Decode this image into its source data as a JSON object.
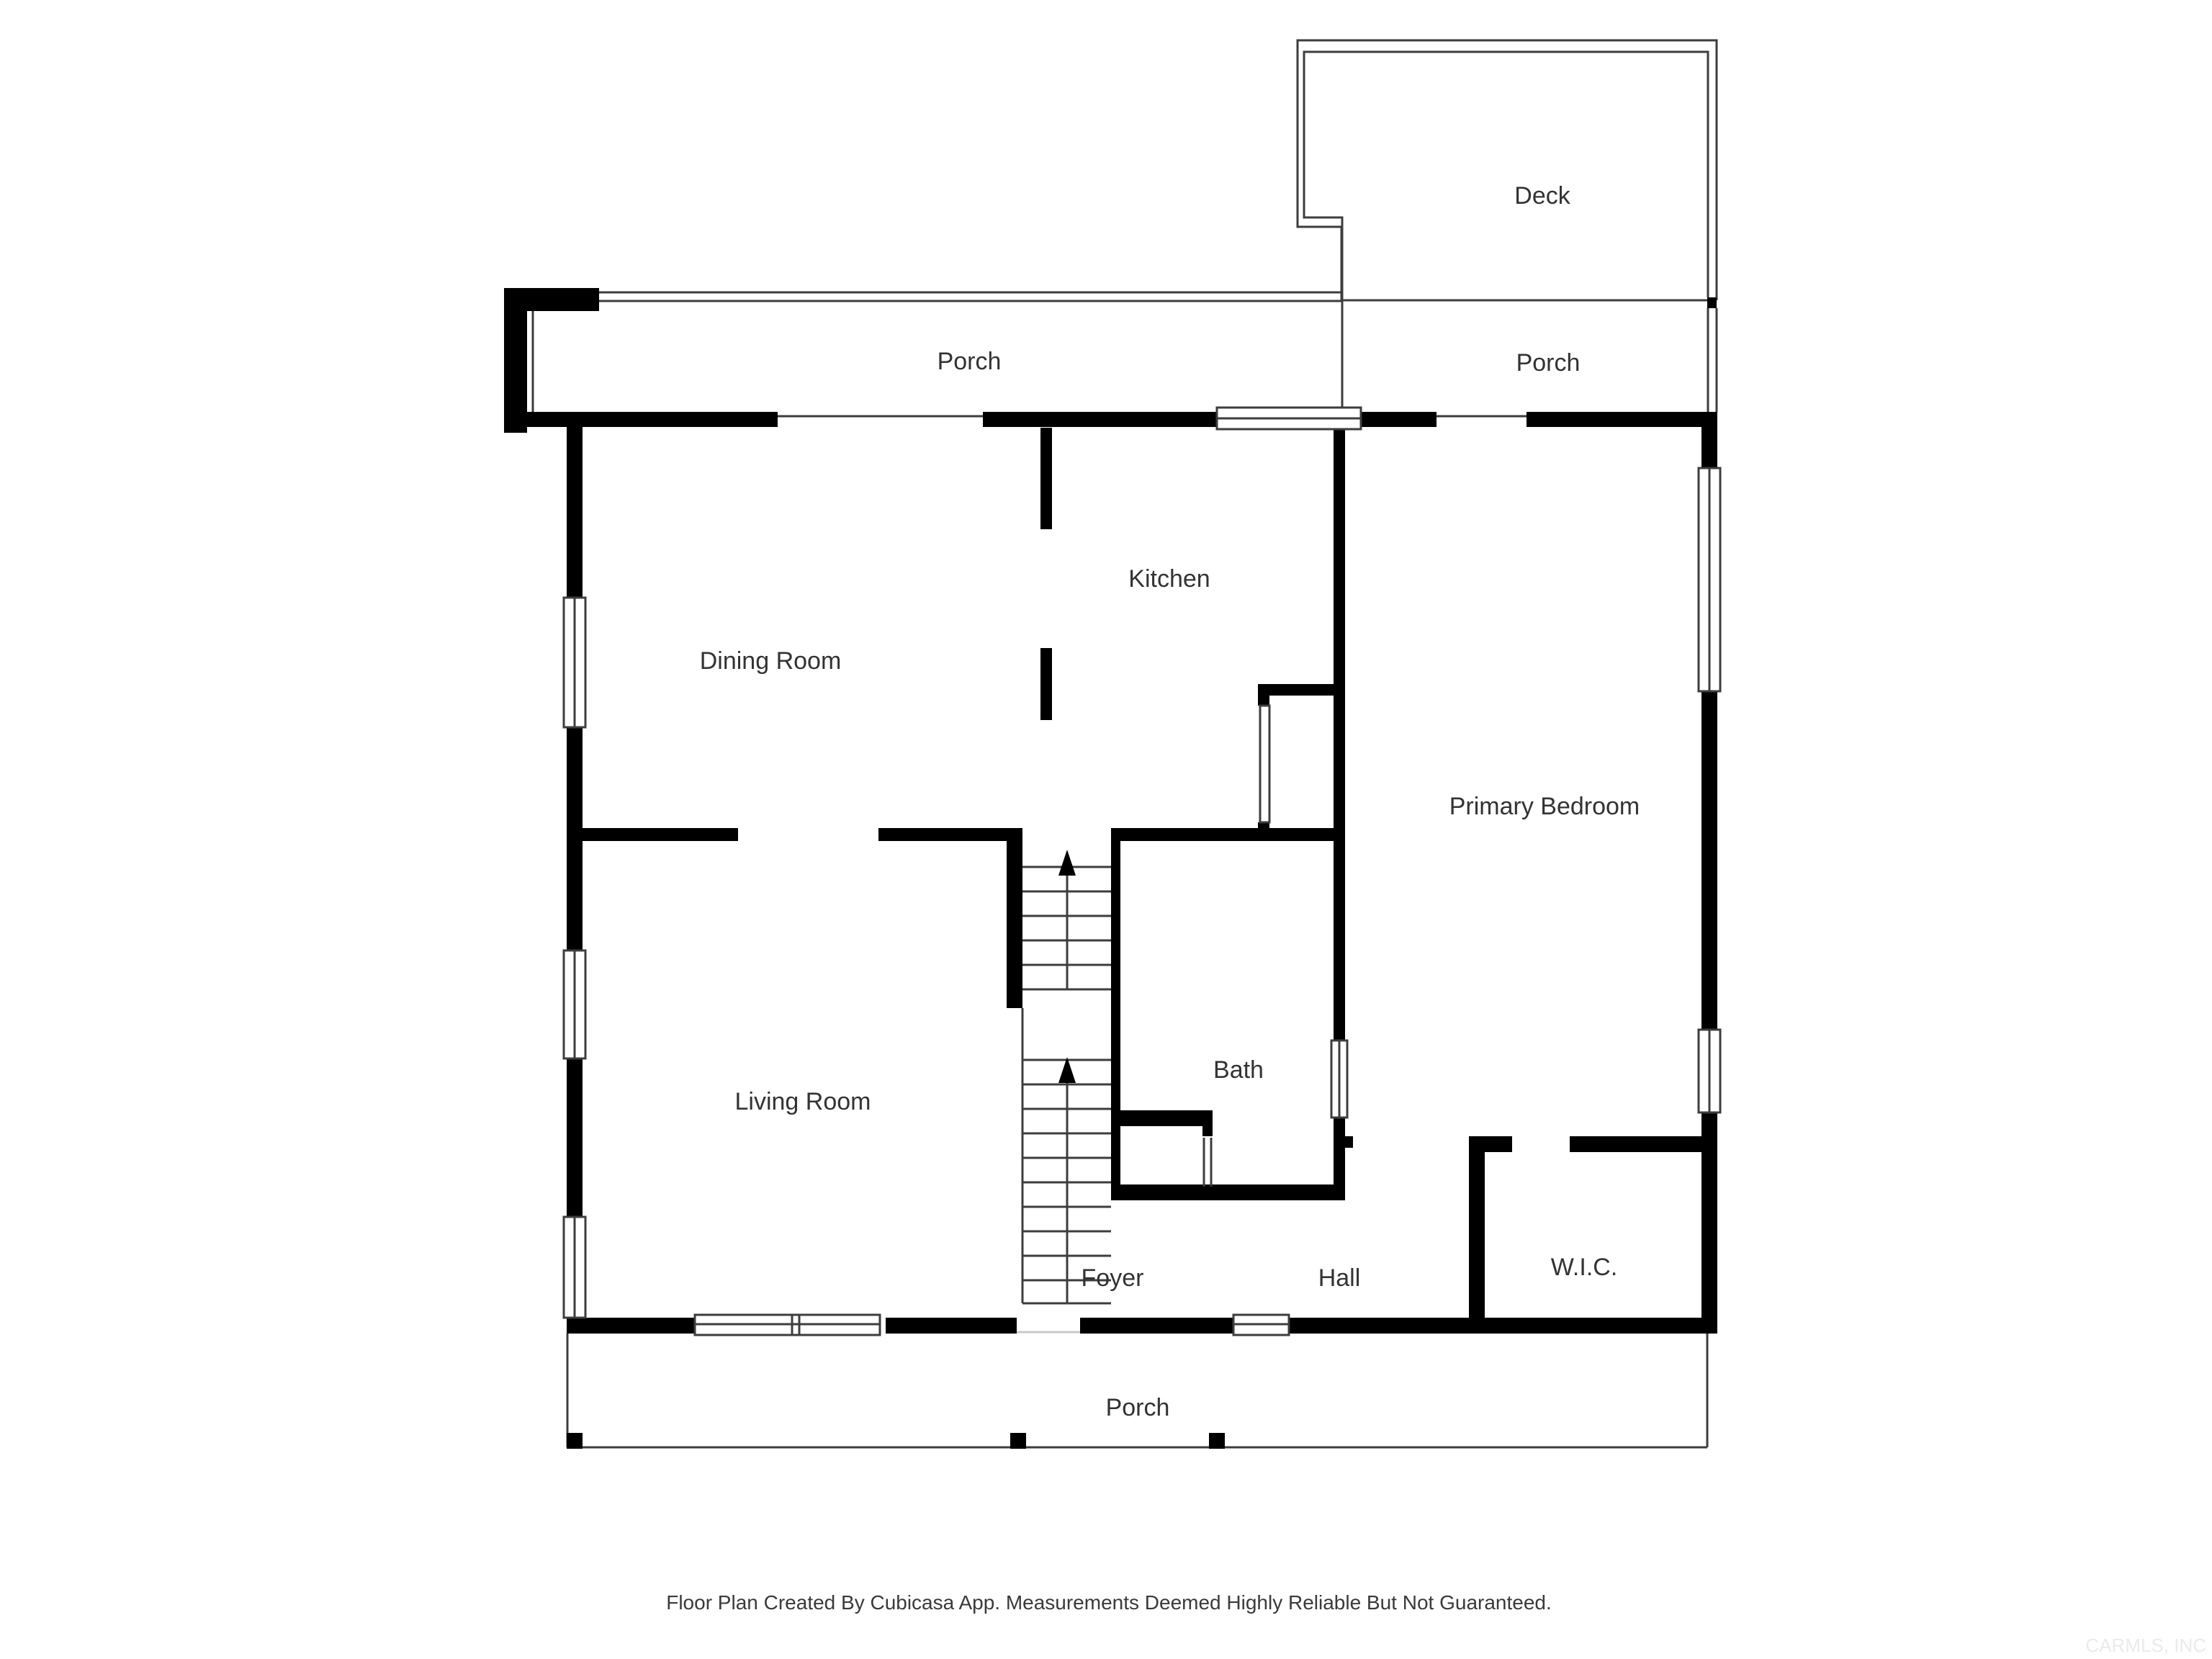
{
  "floor_plan": {
    "rooms": {
      "deck": "Deck",
      "porch_top_left": "Porch",
      "porch_top_right": "Porch",
      "dining_room": "Dining Room",
      "kitchen": "Kitchen",
      "primary_bedroom": "Primary Bedroom",
      "living_room": "Living Room",
      "bath": "Bath",
      "foyer": "Foyer",
      "hall": "Hall",
      "wic": "W.I.C.",
      "porch_bottom": "Porch"
    },
    "footer": {
      "disclaimer": "Floor Plan Created By Cubicasa App. Measurements Deemed Highly Reliable But Not Guaranteed."
    },
    "watermark": "CARMLS, INC",
    "colors": {
      "wall": "#000000",
      "thin_line": "#3d3d3d",
      "label": "#333333",
      "footer_text": "#3a3a3a",
      "watermark_text": "#ebebeb",
      "background": "#ffffff"
    }
  }
}
